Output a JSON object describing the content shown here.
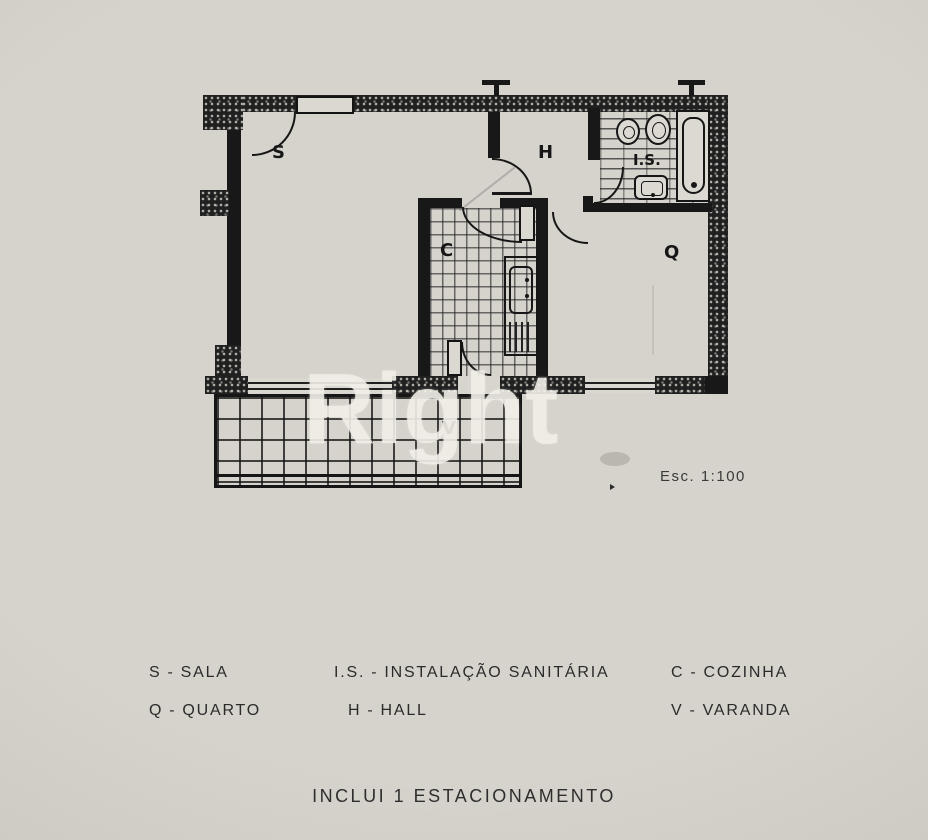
{
  "page": {
    "paper_color": "#d2cfc8",
    "ink_color": "#1a1a1a",
    "watermark_color": "#f0eee7"
  },
  "watermark": {
    "text": "Right"
  },
  "plan": {
    "scale_label": "Esc. 1:100",
    "rooms": [
      {
        "id": "sala",
        "label": "S"
      },
      {
        "id": "hall",
        "label": "H"
      },
      {
        "id": "instalacao-sanitaria",
        "label": "I.S."
      },
      {
        "id": "cozinha",
        "label": "C"
      },
      {
        "id": "quarto",
        "label": "Q"
      },
      {
        "id": "varanda",
        "label": "V"
      }
    ]
  },
  "legend": {
    "separator": "-",
    "items": [
      {
        "key": "S",
        "name": "SALA"
      },
      {
        "key": "I.S.",
        "name": "INSTALAÇÃO SANITÁRIA"
      },
      {
        "key": "C",
        "name": "COZINHA"
      },
      {
        "key": "Q",
        "name": "QUARTO"
      },
      {
        "key": "H",
        "name": "HALL"
      },
      {
        "key": "V",
        "name": "VARANDA"
      }
    ]
  },
  "footer": {
    "note": "INCLUI 1 ESTACIONAMENTO"
  }
}
